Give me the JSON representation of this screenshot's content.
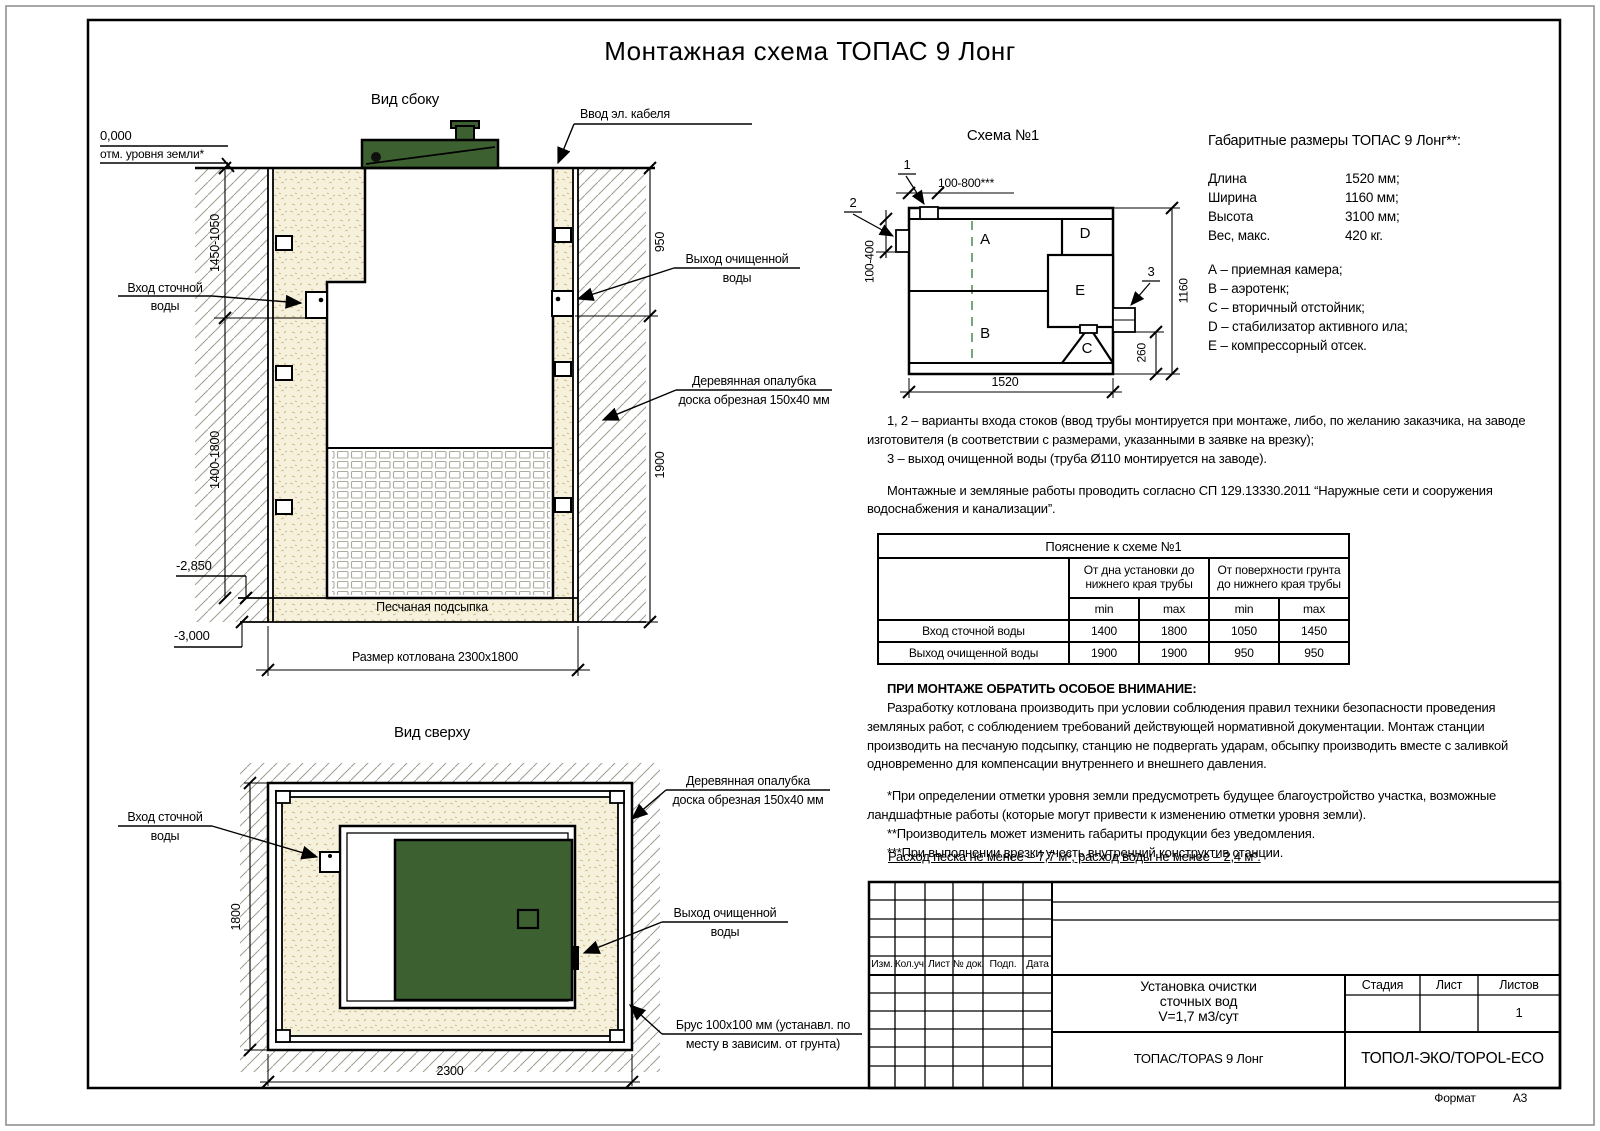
{
  "page": {
    "title": "Монтажная схема ТОПАС 9 Лонг",
    "format_label": "Формат",
    "format_value": "А3"
  },
  "side_view": {
    "title": "Вид сбоку",
    "zero_mark": "0,000",
    "zero_note": "отм. уровня земли*",
    "cable_label": "Ввод эл. кабеля",
    "inlet_line1": "Вход сточной",
    "inlet_line2": "воды",
    "outlet_line1": "Выход очищенной",
    "outlet_line2": "воды",
    "formwork_line1": "Деревянная опалубка",
    "formwork_line2": "доска обрезная 150х40 мм",
    "sand_label": "Песчаная подсыпка",
    "pit_label": "Размер котлована 2300х1800",
    "dim_upper_left": "1450-1050",
    "dim_lower_left": "1400-1800",
    "dim_upper_right": "950",
    "dim_lower_right": "1900",
    "level_1": "-2,850",
    "level_2": "-3,000"
  },
  "top_view": {
    "title": "Вид сверху",
    "inlet_line1": "Вход сточной",
    "inlet_line2": "воды",
    "formwork_line1": "Деревянная опалубка",
    "formwork_line2": "доска обрезная 150х40 мм",
    "outlet_line1": "Выход очищенной",
    "outlet_line2": "воды",
    "beam_line1": "Брус 100х100 мм (устанавл. по",
    "beam_line2": "месту в зависим. от грунта)",
    "dim_left": "1800",
    "dim_bottom": "2300"
  },
  "scheme": {
    "title": "Схема №1",
    "callout_1": "1",
    "callout_2": "2",
    "callout_3": "3",
    "dim_top": "100-800***",
    "dim_left": "100-400",
    "dim_right": "1160",
    "dim_outlet": "260",
    "dim_bottom": "1520",
    "compartment_a": "A",
    "compartment_b": "B",
    "compartment_c": "C",
    "compartment_d": "D",
    "compartment_e": "E"
  },
  "specs": {
    "heading": "Габаритные размеры ТОПАС 9 Лонг**:",
    "rows": [
      {
        "label": "Длина",
        "value": "1520 мм;"
      },
      {
        "label": "Ширина",
        "value": "1160 мм;"
      },
      {
        "label": "Высота",
        "value": "3100 мм;"
      },
      {
        "label": "Вес, макс.",
        "value": "420 кг."
      }
    ],
    "legend": [
      "А – приемная камера;",
      "В – аэротенк;",
      "С – вторичный отстойник;",
      "D – стабилизатор активного ила;",
      "Е – компрессорный отсек."
    ]
  },
  "notes": {
    "p1": "1, 2 – варианты входа  стоков (ввод трубы монтируется при монтаже, либо, по желанию заказчика, на заводе изготовителя (в соответствии с размерами, указанными в заявке на врезку);",
    "p2": "3 – выход очищенной воды (труба Ø110 монтируется на заводе).",
    "p3": "Монтажные и земляные работы проводить согласно СП 129.13330.2011 “Наружные сети и сооружения водоснабжения и канализации”."
  },
  "table": {
    "title": "Пояснение к схеме №1",
    "group1": "От дна установки до нижнего края трубы",
    "group2": "От поверхности грунта до нижнего края трубы",
    "min_label": "min",
    "max_label": "max",
    "rows": [
      {
        "label": "Вход сточной воды",
        "c1": "1400",
        "c2": "1800",
        "c3": "1050",
        "c4": "1450"
      },
      {
        "label": "Выход очищенной воды",
        "c1": "1900",
        "c2": "1900",
        "c3": "950",
        "c4": "950"
      }
    ]
  },
  "attention": {
    "heading": "ПРИ МОНТАЖЕ ОБРАТИТЬ ОСОБОЕ ВНИМАНИЕ:",
    "body": "Разработку котлована производить при условии соблюдения правил техники безопасности проведения земляных работ, с соблюдением требований действующей нормативной документации. Монтаж станции производить на песчаную подсыпку, станцию не подвергать ударам, обсыпку производить вместе с заливкой одновременно для компенсации внутреннего и внешнего давления.",
    "fn1": "*При определении отметки уровня земли предусмотреть будущее благоустройство участка, возможные ландшафтные работы (которые могут привести к изменению отметки уровня земли).",
    "fn2": "**Производитель может изменить габариты продукции без уведомления.",
    "fn3": "***При выполнении врезки учесть внутренний конструктив станции.",
    "consumption": "Расход песка не менее – 7,7 м³, расход воды не менее – 2,4 м³."
  },
  "stamp": {
    "columns": [
      "Изм.",
      "Кол.уч.",
      "Лист",
      "№ док.",
      "Подп.",
      "Дата"
    ],
    "title_line1": "Установка очистки",
    "title_line2": "сточных вод",
    "title_line3": "V=1,7 м3/сут",
    "stage_label": "Стадия",
    "sheet_label": "Лист",
    "sheets_label": "Листов",
    "sheets_value": "1",
    "product": "ТОПАС/TOPAS 9 Лонг",
    "company": "ТОПОЛ-ЭКО/TOPOL-ECO"
  },
  "colors": {
    "lid_green": "#3d6030",
    "sand_fill": "#f6f1dd",
    "hatch_line": "#9c9c8f",
    "dashed_green": "#2f7a33"
  }
}
